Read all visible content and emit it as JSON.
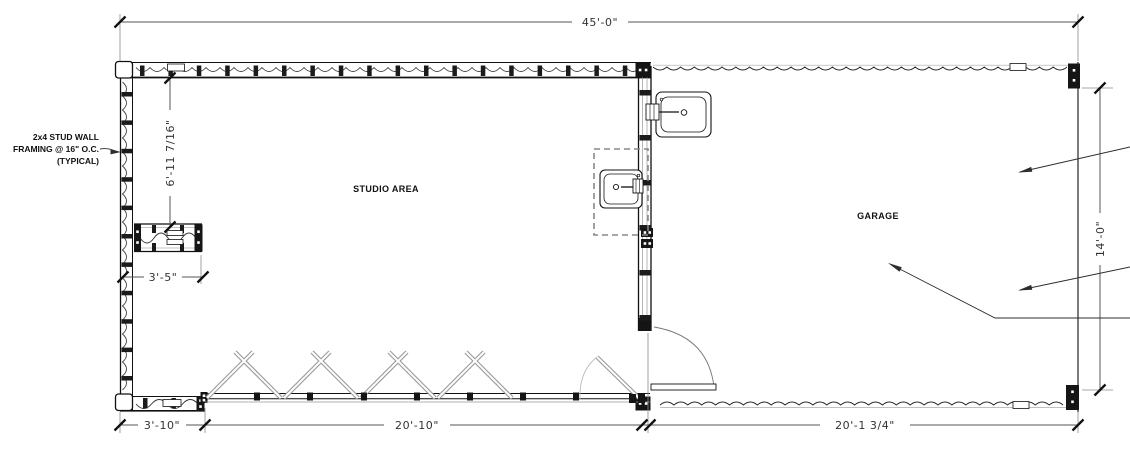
{
  "drawing_labels": {
    "studio_area": "STUDIO AREA",
    "garage": "GARAGE"
  },
  "wall_note": {
    "line1": "2x4 STUD WALL",
    "line2": "FRAMING @ 16\" O.C.",
    "line3": "(TYPICAL)"
  },
  "dimensions": {
    "overall_width": "45'-0\"",
    "studio_wall_segment": "6'-11 7/16\"",
    "stub_wall": "3'-5\"",
    "garage_depth": "14'-0\"",
    "bottom_left_wall": "3'-10\"",
    "folding_door_opening": "20'-10\"",
    "garage_length": "20'-1 3/4\""
  },
  "colors": {
    "wall_line": "#1a1a1a",
    "dim_line": "#555555",
    "dim_text": "#333333",
    "door_gray": "#9a9a9a",
    "background": "#ffffff"
  }
}
